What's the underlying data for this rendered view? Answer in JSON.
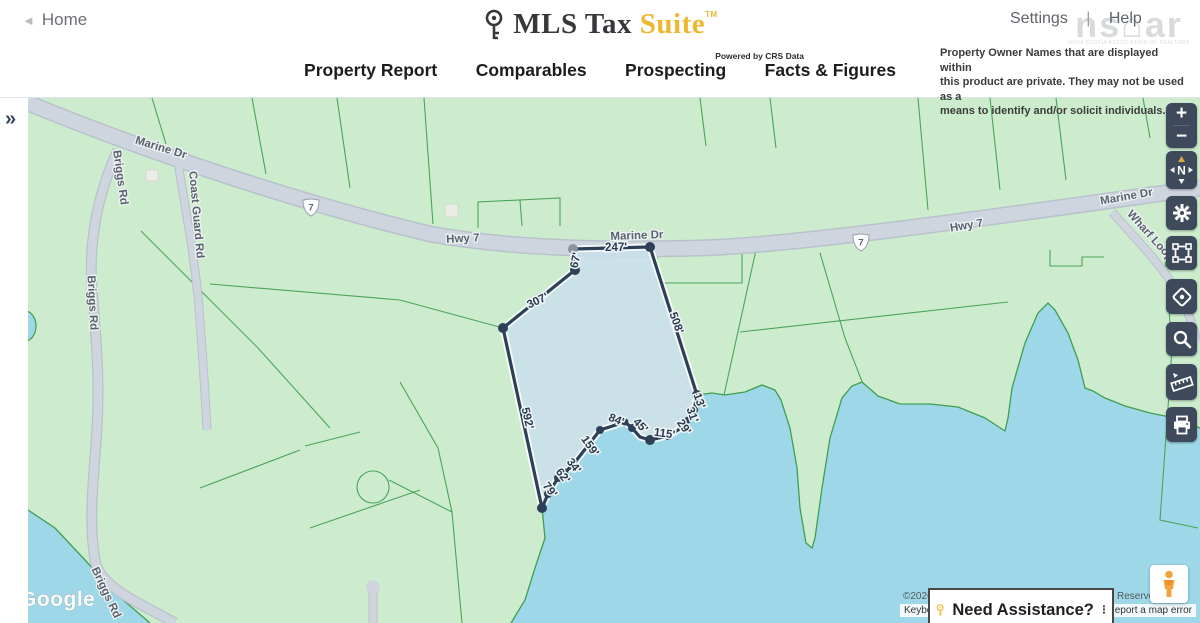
{
  "header": {
    "home_label": "Home",
    "home_arrow": "◄",
    "logo": {
      "brand_prefix": "MLS Tax",
      "brand_suffix": "Suite",
      "tm": "TM",
      "tagline": "Powered by CRS Data"
    },
    "links": {
      "settings": "Settings",
      "divider": "|",
      "help": "Help"
    },
    "watermark": {
      "text": "ns⌂ar",
      "subtext": "NOVA SCOTIA ASSOCIATION OF REALTORS"
    },
    "disclaimer_lines": [
      "Property Owner Names that are displayed within",
      "this product are private. They may not be used as a",
      "means to identify and/or solicit individuals."
    ],
    "tabs": [
      {
        "label": "Property Report"
      },
      {
        "label": "Comparables"
      },
      {
        "label": "Prospecting"
      },
      {
        "label": "Facts & Figures"
      }
    ]
  },
  "map": {
    "expand_icon": "»",
    "road_labels": [
      {
        "text": "Marine Dr"
      },
      {
        "text": "Hwy 7"
      },
      {
        "text": "Marine Dr"
      },
      {
        "text": "Hwy 7"
      },
      {
        "text": "Marine Dr"
      },
      {
        "text": "Briggs Rd"
      },
      {
        "text": "Briggs Rd"
      },
      {
        "text": "Briggs Rd"
      },
      {
        "text": "Coast Guard Rd"
      },
      {
        "text": "Wharf Loop"
      }
    ],
    "route_shields": [
      {
        "text": "7"
      },
      {
        "text": "7"
      }
    ],
    "measurements": [
      {
        "label": "247'"
      },
      {
        "label": "67'"
      },
      {
        "label": "307'"
      },
      {
        "label": "508'"
      },
      {
        "label": "592'"
      },
      {
        "label": "79'"
      },
      {
        "label": "62'"
      },
      {
        "label": "34'"
      },
      {
        "label": "159'"
      },
      {
        "label": "84'"
      },
      {
        "label": "45'"
      },
      {
        "label": "115'"
      },
      {
        "label": "29'"
      },
      {
        "label": "31'"
      },
      {
        "label": "13'"
      }
    ],
    "controls": {
      "zoom_in": "+",
      "zoom_out": "−",
      "compass_n": "N"
    },
    "attribution": {
      "copyright": "©2026",
      "keyboard": "Keyboa",
      "reserved": "Reserved.",
      "report_error": "Report a map error",
      "google": "Google"
    },
    "assistance": {
      "text": "Need Assistance?",
      "menu_icon": "⁝"
    }
  },
  "colors": {
    "brand_gold": "#edb72f",
    "land_green": "#cdeccd",
    "water_blue": "#9ed8e8",
    "parcel_line_green": "#4aa45b",
    "road_gray": "#ced5df",
    "parcel_boundary_navy": "#2e4057",
    "parcel_highlight": "#c9dfeb",
    "control_button_slate": "#3e4a5c",
    "compass_needle_gold": "#e0a93e"
  }
}
